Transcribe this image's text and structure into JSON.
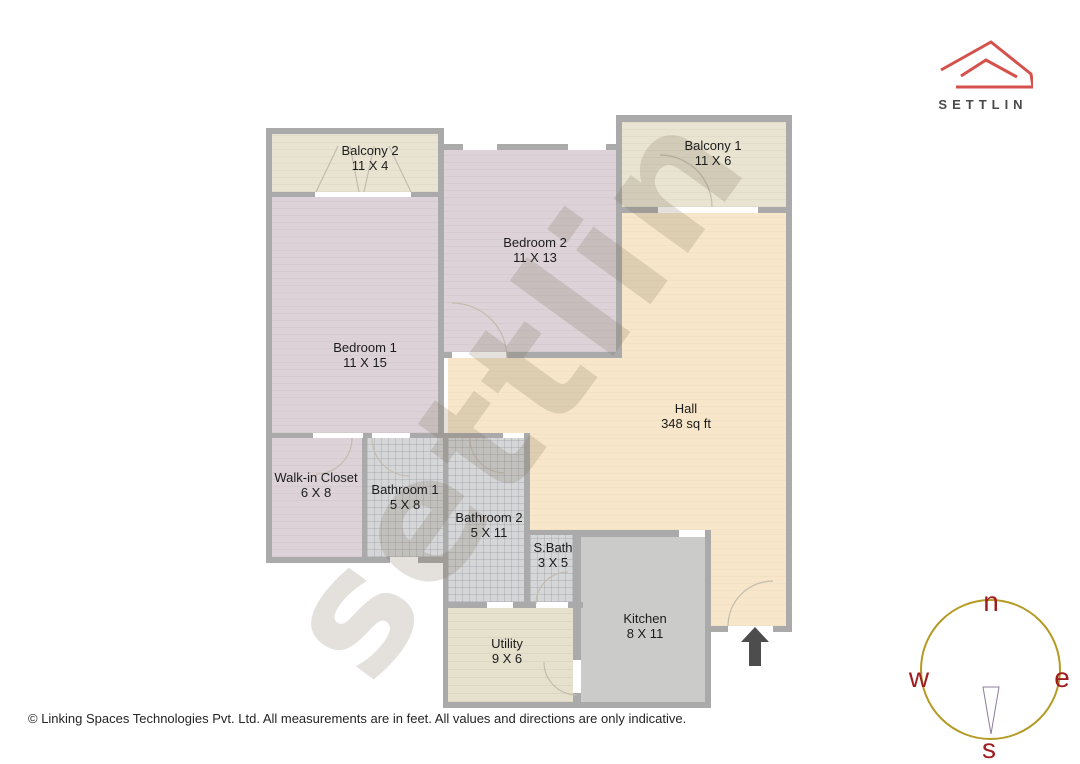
{
  "logo": {
    "brand": "SETTLIN"
  },
  "floorplan": {
    "watermark": "settlin",
    "rooms": [
      {
        "id": "balcony-2",
        "name": "Balcony 2",
        "dims": "11 X 4"
      },
      {
        "id": "bedroom-1",
        "name": "Bedroom 1",
        "dims": "11 X 15"
      },
      {
        "id": "bedroom-2",
        "name": "Bedroom 2",
        "dims": "11 X 13"
      },
      {
        "id": "balcony-1",
        "name": "Balcony 1",
        "dims": "11 X 6"
      },
      {
        "id": "hall",
        "name": "Hall",
        "dims": "348 sq ft"
      },
      {
        "id": "walk-in-closet",
        "name": "Walk-in Closet",
        "dims": "6 X 8"
      },
      {
        "id": "bathroom-1",
        "name": "Bathroom 1",
        "dims": "5 X 8"
      },
      {
        "id": "bathroom-2",
        "name": "Bathroom 2",
        "dims": "5 X 11"
      },
      {
        "id": "s-bath",
        "name": "S.Bath",
        "dims": "3 X 5"
      },
      {
        "id": "kitchen",
        "name": "Kitchen",
        "dims": "8 X 11"
      },
      {
        "id": "utility",
        "name": "Utility",
        "dims": "9 X 6"
      }
    ]
  },
  "compass": {
    "north": "n",
    "east": "e",
    "south": "s",
    "west": "w"
  },
  "footer": {
    "copyright": "© Linking Spaces Technologies Pvt. Ltd. All measurements are in feet. All values and directions are only indicative."
  },
  "colors": {
    "brand_red": "#d5514c",
    "wall_gray": "#aaaaaa",
    "bedroom_pink": "#ddd2d7",
    "balcony_beige": "#e8e4d1",
    "hall_peach": "#f7e6c9",
    "bath_tile": "#d5d6d7",
    "kitchen_gray": "#cbcbc9",
    "utility_beige": "#e6e1cd",
    "compass_ring": "#b49b25",
    "compass_letters": "#9e1d1d"
  }
}
